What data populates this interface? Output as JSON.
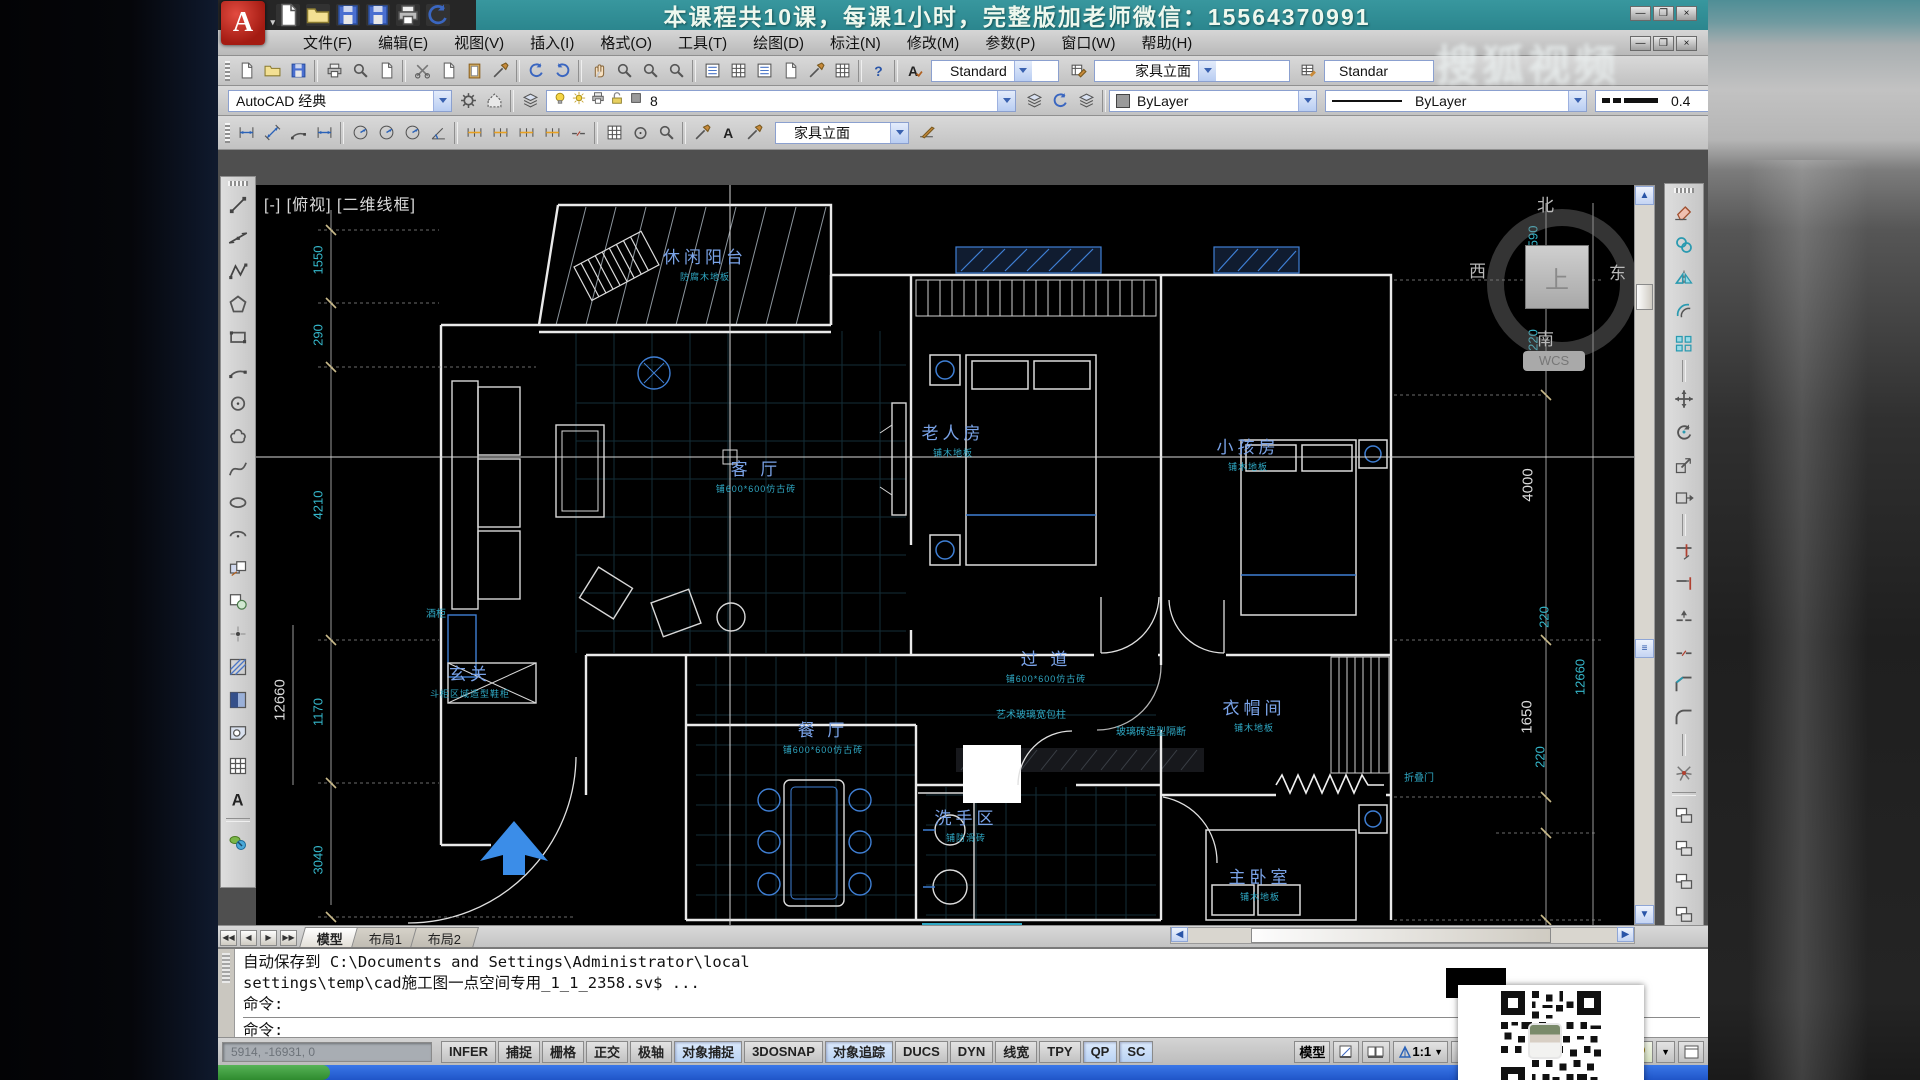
{
  "banner": {
    "course_text": "本课程共10课，每课1小时，完整版加老师微信：15564370991"
  },
  "watermark": "搜狐视频",
  "qat": {
    "icons": [
      "new",
      "open",
      "save",
      "save-as",
      "plot",
      "undo"
    ]
  },
  "menu": {
    "items": [
      "文件(F)",
      "编辑(E)",
      "视图(V)",
      "插入(I)",
      "格式(O)",
      "工具(T)",
      "绘图(D)",
      "标注(N)",
      "修改(M)",
      "参数(P)",
      "窗口(W)",
      "帮助(H)"
    ]
  },
  "toolbar_standard": {
    "icons": [
      "qnew",
      "open",
      "save",
      "|",
      "plot",
      "plot-preview",
      "publish",
      "|",
      "cut",
      "copy-clip",
      "paste",
      "matchprop",
      "|",
      "undo",
      "redo",
      "|",
      "pan",
      "zoom-realtime",
      "zoom-window",
      "zoom-previous",
      "|",
      "properties",
      "designcenter",
      "tool-palettes",
      "sheetset-manager",
      "markup",
      "quickcalc",
      "|",
      "help"
    ]
  },
  "styles_bar": {
    "text_style": "Standard",
    "dim_style": "家具立面",
    "table_style": "Standar"
  },
  "workspace_bar": {
    "workspace": "AutoCAD 经典",
    "icons": [
      "gear",
      "workspace-settings"
    ]
  },
  "layer_bar": {
    "manager_icon": "layer-properties",
    "layer": {
      "name": "8",
      "state_icons": [
        "bulb",
        "sun",
        "plot-state",
        "unlock",
        "color-swatch"
      ]
    },
    "icons": [
      "make-object-layer",
      "layer-previous",
      "layer-states"
    ]
  },
  "properties_bar": {
    "color": "ByLayer",
    "linetype": "ByLayer",
    "lineweight": "0.4"
  },
  "dim_toolbar": {
    "icons": [
      "dim-linear",
      "dim-aligned",
      "dim-arc-length",
      "dim-ordinate",
      "|",
      "dim-radius",
      "dim-jogged",
      "dim-diameter",
      "dim-angular",
      "|",
      "dim-quick",
      "dim-baseline",
      "dim-continue",
      "dim-space",
      "dim-break",
      "|",
      "dim-tolerance",
      "dim-center-mark",
      "dim-inspect",
      "|",
      "dim-edit",
      "dim-text-edit",
      "dim-update"
    ],
    "style": "家具立面"
  },
  "draw_toolbar": {
    "icons": [
      "line",
      "xline",
      "polyline",
      "polygon",
      "rectangle",
      "arc",
      "circle",
      "revcloud",
      "spline",
      "ellipse",
      "ellipse-arc",
      "insert-block",
      "make-block",
      "point",
      "hatch",
      "gradient",
      "region",
      "table",
      "mtext"
    ]
  },
  "modify_toolbar": {
    "icons": [
      "erase",
      "copy",
      "mirror",
      "offset",
      "array",
      "|",
      "move",
      "rotate",
      "scale",
      "stretch",
      "|",
      "trim",
      "extend",
      "break-at-point",
      "break",
      "chamfer",
      "fillet",
      "|",
      "explode"
    ],
    "extra": [
      "group",
      "group-edit",
      "ungroup",
      "group-select"
    ],
    "abc": "ABC"
  },
  "canvas": {
    "viewport_label": "[-] [俯视] [二维线框]",
    "compass": {
      "north": "北",
      "south": "南",
      "west": "西",
      "east": "东",
      "badge": "WCS",
      "cube": "上"
    },
    "rooms": [
      {
        "name": "休闲阳台",
        "sub": "防腐木地板",
        "x": 449,
        "y": 78
      },
      {
        "name": "客 厅",
        "sub": "铺600*600仿古砖",
        "x": 500,
        "y": 290
      },
      {
        "name": "老人房",
        "sub": "铺木地板",
        "x": 697,
        "y": 254
      },
      {
        "name": "小孩房",
        "sub": "铺木地板",
        "x": 992,
        "y": 268
      },
      {
        "name": "过 道",
        "sub": "铺600*600仿古砖",
        "x": 790,
        "y": 480
      },
      {
        "name": "玄关",
        "sub": "斗柜区域造型鞋柜",
        "x": 214,
        "y": 495
      },
      {
        "name": "餐 厅",
        "sub": "铺600*600仿古砖",
        "x": 567,
        "y": 551
      },
      {
        "name": "洗手区",
        "sub": "铺防滑砖",
        "x": 710,
        "y": 639
      },
      {
        "name": "衣帽间",
        "sub": "铺木地板",
        "x": 998,
        "y": 529
      },
      {
        "name": "主卧室",
        "sub": "铺木地板",
        "x": 1004,
        "y": 698
      }
    ],
    "annotations": [
      {
        "text": "艺术玻璃宽包柱",
        "x": 740,
        "y": 521
      },
      {
        "text": "玻璃砖造型隔断",
        "x": 860,
        "y": 538
      },
      {
        "text": "酒柜",
        "x": 170,
        "y": 420
      },
      {
        "text": "折叠门",
        "x": 1148,
        "y": 584
      }
    ],
    "dims_left": [
      {
        "v": "1550",
        "x": 62,
        "y": 75,
        "big": false
      },
      {
        "v": "290",
        "x": 62,
        "y": 150,
        "big": false
      },
      {
        "v": "4210",
        "x": 62,
        "y": 320,
        "big": false
      },
      {
        "v": "12660",
        "x": 24,
        "y": 515,
        "big": true
      },
      {
        "v": "1170",
        "x": 62,
        "y": 527,
        "big": false
      },
      {
        "v": "3040",
        "x": 62,
        "y": 675,
        "big": false
      }
    ],
    "dims_right": [
      {
        "v": "2590",
        "x": 1277,
        "y": 55,
        "big": false
      },
      {
        "v": "220",
        "x": 1277,
        "y": 155,
        "big": false
      },
      {
        "v": "4000",
        "x": 1272,
        "y": 300,
        "big": true
      },
      {
        "v": "220",
        "x": 1288,
        "y": 432,
        "big": false
      },
      {
        "v": "12660",
        "x": 1324,
        "y": 492,
        "big": false
      },
      {
        "v": "1650",
        "x": 1271,
        "y": 532,
        "big": true
      },
      {
        "v": "220",
        "x": 1284,
        "y": 572,
        "big": false
      }
    ]
  },
  "tabs": {
    "items": [
      "模型",
      "布局1",
      "布局2"
    ],
    "active_index": 0
  },
  "command": {
    "history": [
      "自动保存到 C:\\Documents and Settings\\Administrator\\local",
      "settings\\temp\\cad施工图一点空间专用_1_1_2358.sv$ ...",
      "命令:"
    ],
    "prompt": "命令:"
  },
  "status": {
    "coords": "5914, -16931, 0",
    "toggles": [
      {
        "label": "INFER",
        "active": false
      },
      {
        "label": "捕捉",
        "active": false
      },
      {
        "label": "栅格",
        "active": false
      },
      {
        "label": "正交",
        "active": false
      },
      {
        "label": "极轴",
        "active": false
      },
      {
        "label": "对象捕捉",
        "active": true
      },
      {
        "label": "3DOSNAP",
        "active": false
      },
      {
        "label": "对象追踪",
        "active": true
      },
      {
        "label": "DUCS",
        "active": false
      },
      {
        "label": "DYN",
        "active": false
      },
      {
        "label": "线宽",
        "active": false
      },
      {
        "label": "TPY",
        "active": false
      },
      {
        "label": "QP",
        "active": true
      },
      {
        "label": "SC",
        "active": true
      }
    ],
    "right": {
      "model_label": "模型",
      "scale": "1:1"
    }
  }
}
